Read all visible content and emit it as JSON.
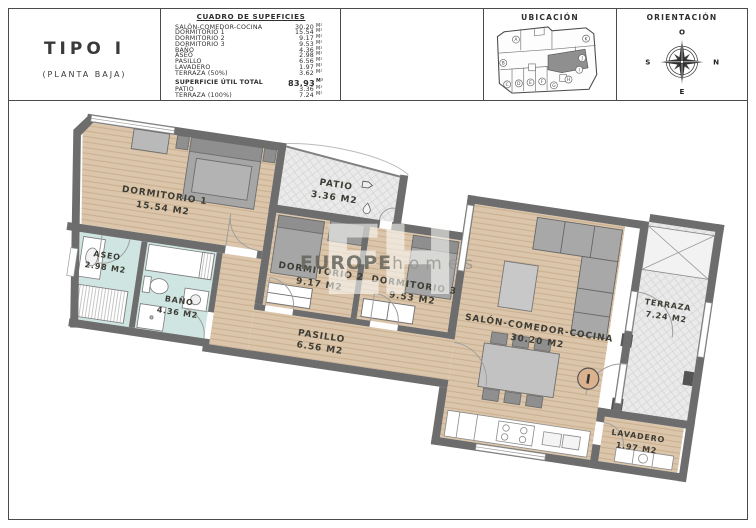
{
  "header": {
    "tipo": {
      "title": "TIPO I",
      "subtitle": "(PLANTA BAJA)"
    },
    "table": {
      "title": "CUADRO DE SUPEFICIES",
      "unit": "M²",
      "rows": [
        {
          "label": "SALÓN-COMEDOR-COCINA",
          "value": "30.20"
        },
        {
          "label": "DORMITORIO 1",
          "value": "15.54"
        },
        {
          "label": "DORMITORIO 2",
          "value": "9.17"
        },
        {
          "label": "DORMITORIO 3",
          "value": "9.53"
        },
        {
          "label": "BAÑO",
          "value": "4.36"
        },
        {
          "label": "ASEO",
          "value": "2.98"
        },
        {
          "label": "PASILLO",
          "value": "6.56"
        },
        {
          "label": "LAVADERO",
          "value": "1.97"
        },
        {
          "label": "TERRAZA (50%)",
          "value": "3.62"
        }
      ],
      "total": {
        "label": "SUPERFICIE ÚTIL TOTAL",
        "value": "83.93"
      },
      "extra": [
        {
          "label": "PATIO",
          "value": "3.36"
        },
        {
          "label": "TERRAZA (100%)",
          "value": "7.24"
        }
      ]
    },
    "ubicacion": {
      "title": "UBICACIÓN",
      "units": [
        "A",
        "B",
        "C",
        "D",
        "E",
        "F",
        "G",
        "H",
        "I",
        "J",
        "K"
      ]
    },
    "orientacion": {
      "title": "ORIENTACIÓN",
      "west": "O",
      "north": "N",
      "south": "S",
      "east": "E"
    }
  },
  "plan": {
    "rooms": [
      {
        "name": "DORMITORIO 1",
        "area": "15.54 M2"
      },
      {
        "name": "PATIO",
        "area": "3.36 M2"
      },
      {
        "name": "ASEO",
        "area": "2.98 M2"
      },
      {
        "name": "BAÑO",
        "area": "4.36 M2"
      },
      {
        "name": "DORMITORIO 2",
        "area": "9.17 M2"
      },
      {
        "name": "DORMITORIO 3",
        "area": "9.53 M2"
      },
      {
        "name": "PASILLO",
        "area": "6.56 M2"
      },
      {
        "name": "SALÓN-COMEDOR-COCINA",
        "area": "30.20 M2"
      },
      {
        "name": "TERRAZA",
        "area": "7.24 M2"
      },
      {
        "name": "LAVADERO",
        "area": "1.97 M2"
      }
    ],
    "entrance_marker": "I"
  },
  "watermark": {
    "initials": "EH",
    "brand": "EUROPE",
    "suffix": "homes"
  },
  "colors": {
    "wall": "#6d6d6d",
    "wood": "#dcc6ab",
    "wet_room": "#cfe5e2",
    "tile": "#eaeaea",
    "marker_fill": "#dcb28e"
  }
}
